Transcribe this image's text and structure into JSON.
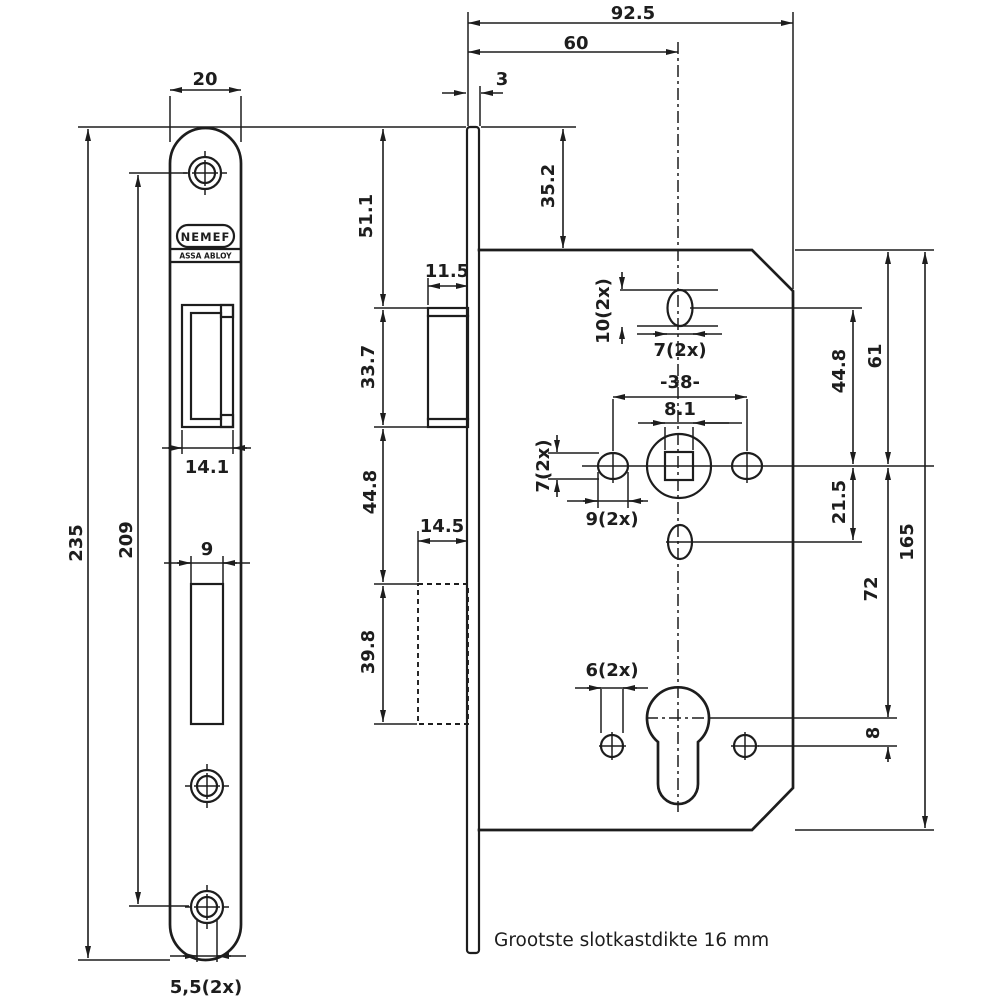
{
  "drawing": {
    "brand": {
      "logo": "NEMEF",
      "sub_logo": "ASSA ABLOY"
    },
    "note": "Grootste slotkastdikte 16 mm",
    "colors": {
      "line": "#1d1d1d",
      "background": "#ffffff"
    },
    "dim_labels": [
      {
        "id": "faceplate-width",
        "text": "20",
        "x": 205,
        "y": 80,
        "rot": 0
      },
      {
        "id": "faceplate-height",
        "text": "235",
        "x": 77,
        "y": 543,
        "rot": -90
      },
      {
        "id": "screw-distance",
        "text": "209",
        "x": 127,
        "y": 540,
        "rot": -90
      },
      {
        "id": "latch-cutout-width",
        "text": "14.1",
        "x": 207,
        "y": 468,
        "rot": 0
      },
      {
        "id": "bolt-cutout-width",
        "text": "9",
        "x": 207,
        "y": 550,
        "rot": 0
      },
      {
        "id": "screw-hole-dia",
        "text": "5,5(2x)",
        "x": 206,
        "y": 988,
        "rot": 0
      },
      {
        "id": "case-depth-total",
        "text": "92.5",
        "x": 633,
        "y": 14,
        "rot": 0
      },
      {
        "id": "backset",
        "text": "60",
        "x": 576,
        "y": 44,
        "rot": 0
      },
      {
        "id": "faceplate-thickness",
        "text": "3",
        "x": 502,
        "y": 80,
        "rot": 0
      },
      {
        "id": "top-to-latch",
        "text": "51.1",
        "x": 367,
        "y": 216,
        "rot": -90
      },
      {
        "id": "top-to-case",
        "text": "35.2",
        "x": 549,
        "y": 186,
        "rot": -90
      },
      {
        "id": "latch-depth",
        "text": "11.5",
        "x": 447,
        "y": 272,
        "rot": 0
      },
      {
        "id": "latch-height",
        "text": "33.7",
        "x": 369,
        "y": 367,
        "rot": -90
      },
      {
        "id": "latch-to-bolt",
        "text": "44.8",
        "x": 371,
        "y": 492,
        "rot": -90
      },
      {
        "id": "bolt-depth",
        "text": "14.5",
        "x": 442,
        "y": 527,
        "rot": 0
      },
      {
        "id": "bolt-height",
        "text": "39.8",
        "x": 369,
        "y": 652,
        "rot": -90
      },
      {
        "id": "oval-hole-height",
        "text": "10(2x)",
        "x": 604,
        "y": 311,
        "rot": -90
      },
      {
        "id": "oval-hole-width",
        "text": "7(2x)",
        "x": 680,
        "y": 351,
        "rot": 0
      },
      {
        "id": "side-hole-spacing",
        "text": "-38-",
        "x": 680,
        "y": 383,
        "rot": 0
      },
      {
        "id": "spindle-square",
        "text": "8.1",
        "x": 680,
        "y": 410,
        "rot": 0
      },
      {
        "id": "side-hole-height",
        "text": "7(2x)",
        "x": 544,
        "y": 466,
        "rot": -90
      },
      {
        "id": "side-hole-width",
        "text": "9(2x)",
        "x": 612,
        "y": 520,
        "rot": 0
      },
      {
        "id": "oval-to-spindle",
        "text": "44.8",
        "x": 840,
        "y": 371,
        "rot": -90
      },
      {
        "id": "case-top-to-spindle",
        "text": "61",
        "x": 876,
        "y": 356,
        "rot": -90
      },
      {
        "id": "spindle-to-lower-oval",
        "text": "21.5",
        "x": 840,
        "y": 502,
        "rot": -90
      },
      {
        "id": "case-height",
        "text": "165",
        "x": 908,
        "y": 542,
        "rot": -90
      },
      {
        "id": "spindle-to-cylinder",
        "text": "72",
        "x": 872,
        "y": 589,
        "rot": -90
      },
      {
        "id": "cylinder-to-fixholes",
        "text": "8",
        "x": 874,
        "y": 733,
        "rot": -90
      },
      {
        "id": "fix-hole-dia",
        "text": "6(2x)",
        "x": 612,
        "y": 671,
        "rot": 0
      }
    ]
  }
}
